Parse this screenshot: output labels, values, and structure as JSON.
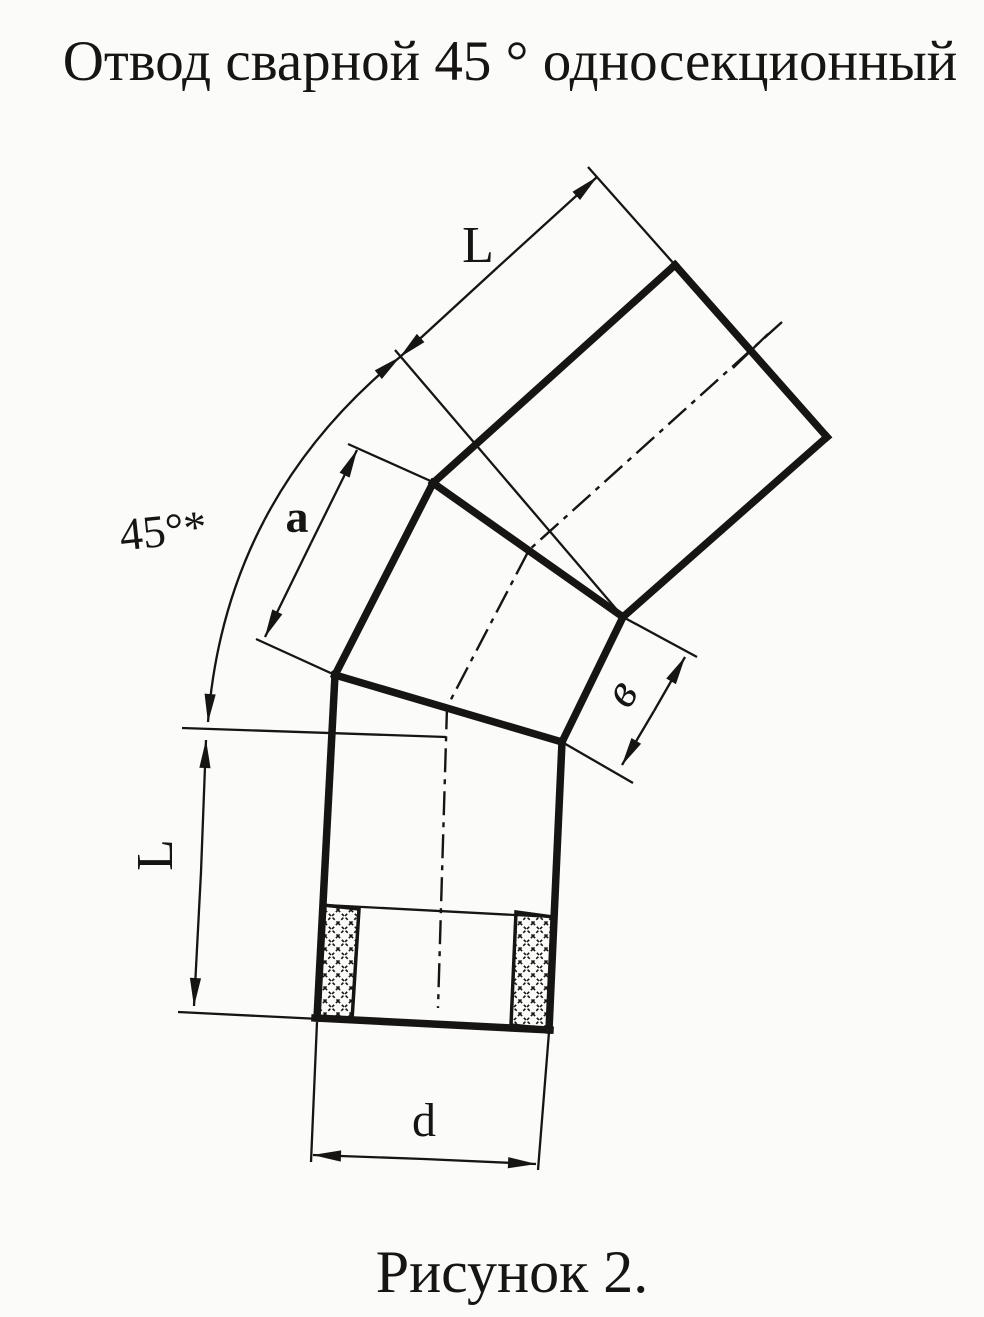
{
  "title": "Отвод сварной 45 ° односекционный",
  "caption": "Рисунок 2.",
  "dimensions": {
    "top_length": "L",
    "bend_angle": "45°*",
    "section_side": "a",
    "section_end_width": "в",
    "bottom_length": "L",
    "diameter": "d"
  },
  "colors": {
    "ink": "#171513",
    "paper": "#fbfbf9"
  }
}
